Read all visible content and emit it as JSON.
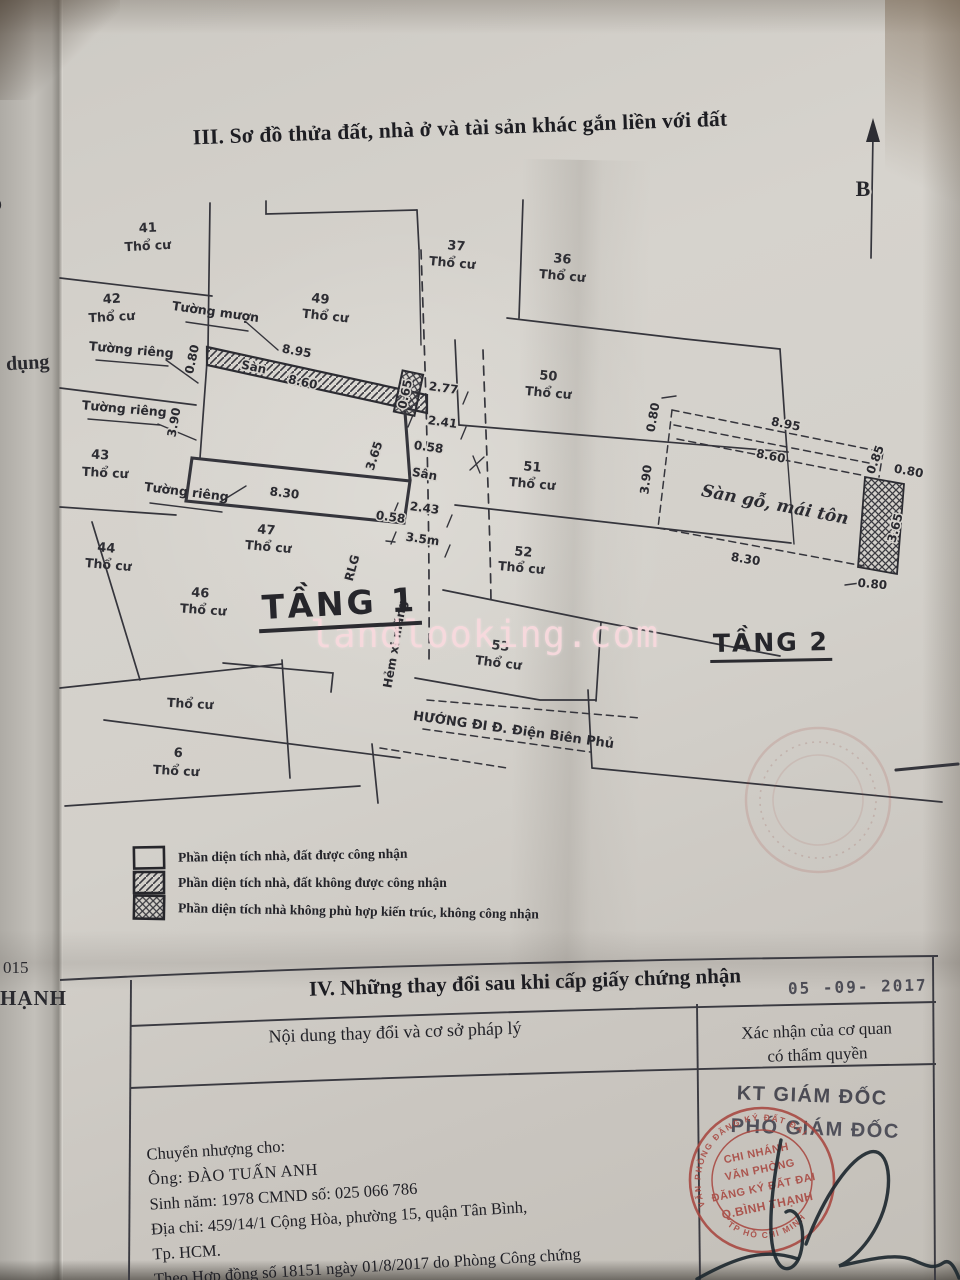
{
  "page": {
    "section3_title": "III. Sơ đồ thửa đất, nhà ở và tài sản khác gắn liền với đất",
    "watermark": "landlooking.com",
    "compass_label": "B",
    "margin_fragments": {
      "left_mid": "dụng",
      "left_bottom_year": "015",
      "left_bottom_word": "HẠNH",
      "left_top": "ỏ"
    }
  },
  "plan1": {
    "title": "TẦNG 1",
    "lots": [
      {
        "number": "41",
        "type": "Thổ cư"
      },
      {
        "number": "37",
        "type": "Thổ cư"
      },
      {
        "number": "36",
        "type": "Thổ cư"
      },
      {
        "number": "42",
        "type": "Thổ cư"
      },
      {
        "number": "49",
        "type": "Thổ cư"
      },
      {
        "number": "50",
        "type": "Thổ cư"
      },
      {
        "number": "43",
        "type": "Thổ cư"
      },
      {
        "number": "51",
        "type": "Thổ cư"
      },
      {
        "number": "44",
        "type": "Thổ cư"
      },
      {
        "number": "47",
        "type": "Thổ cư"
      },
      {
        "number": "52",
        "type": "Thổ cư"
      },
      {
        "number": "46",
        "type": "Thổ cư"
      },
      {
        "number": "53",
        "type": "Thổ cư"
      },
      {
        "number": "",
        "type": "Thổ cư"
      },
      {
        "number": "6",
        "type": "Thổ cư"
      }
    ],
    "walls": {
      "muon": "Tường mượn",
      "rieng1": "Tường riêng",
      "rieng2": "Tường riêng",
      "rieng3": "Tường riêng"
    },
    "dims": {
      "w080": "0.80",
      "w895": "8.95",
      "san_strip": "Sàn",
      "w860": "8.60",
      "w390": "3.90",
      "w277": "2.77",
      "w065": "0.65",
      "w241": "2.41",
      "w058a": "0.58",
      "w365": "3.65",
      "san": "Sân",
      "w830": "8.30",
      "w243": "2.43",
      "w058b": "0.58",
      "w35m": "3.5m",
      "rlg": "RLG",
      "hem": "Hẻm xi măng"
    },
    "direction": "HƯỚNG ĐI Đ. Điện Biên Phủ"
  },
  "plan2": {
    "title": "TẦNG 2",
    "floor_label": "Sàn gỗ, mái tôn",
    "dims": {
      "top080": "0.80",
      "w895": "8.95",
      "w860": "8.60",
      "left390": "3.90",
      "w085": "0.85",
      "right080": "0.80",
      "right365": "3.65",
      "w830": "8.30",
      "bottom080": "0.80"
    }
  },
  "legend": {
    "items": [
      {
        "pattern": "plain",
        "text": "Phần diện tích nhà, đất được công nhận"
      },
      {
        "pattern": "diagonal",
        "text": "Phần diện tích nhà, đất không được công nhận"
      },
      {
        "pattern": "crosshatch",
        "text": "Phần diện tích nhà không phù hợp kiến trúc, không công nhận"
      }
    ]
  },
  "section4": {
    "title": "IV. Những thay đổi sau khi cấp giấy chứng nhận",
    "date_stamp": "05 -09- 2017",
    "columns": {
      "left": "Nội dung thay đổi và cơ sở pháp lý",
      "right_line1": "Xác nhận của cơ quan",
      "right_line2": "có thẩm quyền"
    },
    "transfer": {
      "line1": "Chuyển nhượng cho:",
      "line2": "Ông:  ĐÀO TUẤN ANH",
      "line3": "Sinh năm: 1978   CMND số: 025 066 786",
      "line4": "Địa chỉ:  459/14/1 Cộng Hòa, phường 15, quận Tân Bình,",
      "line5": "Tp. HCM.",
      "line6": "Theo Hợp đồng số 18151 ngày 01/8/2017 do Phòng Công chứng"
    },
    "approval": {
      "kt": "KT GIÁM ĐỐC",
      "pho": "PHÓ GIÁM ĐỐC"
    },
    "stamp": {
      "ring_top": "VĂN PHÒNG ĐĂNG KÝ ĐẤT ĐAI",
      "ring_bottom": "TP HỒ CHÍ MINH",
      "line1": "CHI NHÁNH",
      "line2": "VĂN PHÒNG",
      "line3": "ĐĂNG KÝ ĐẤT ĐAI",
      "line4": "Q.BÌNH THẠNH"
    }
  },
  "colors": {
    "stamp_red": "#a84740",
    "ink": "#26262a",
    "watermark_pink": "#f7d8dd"
  }
}
